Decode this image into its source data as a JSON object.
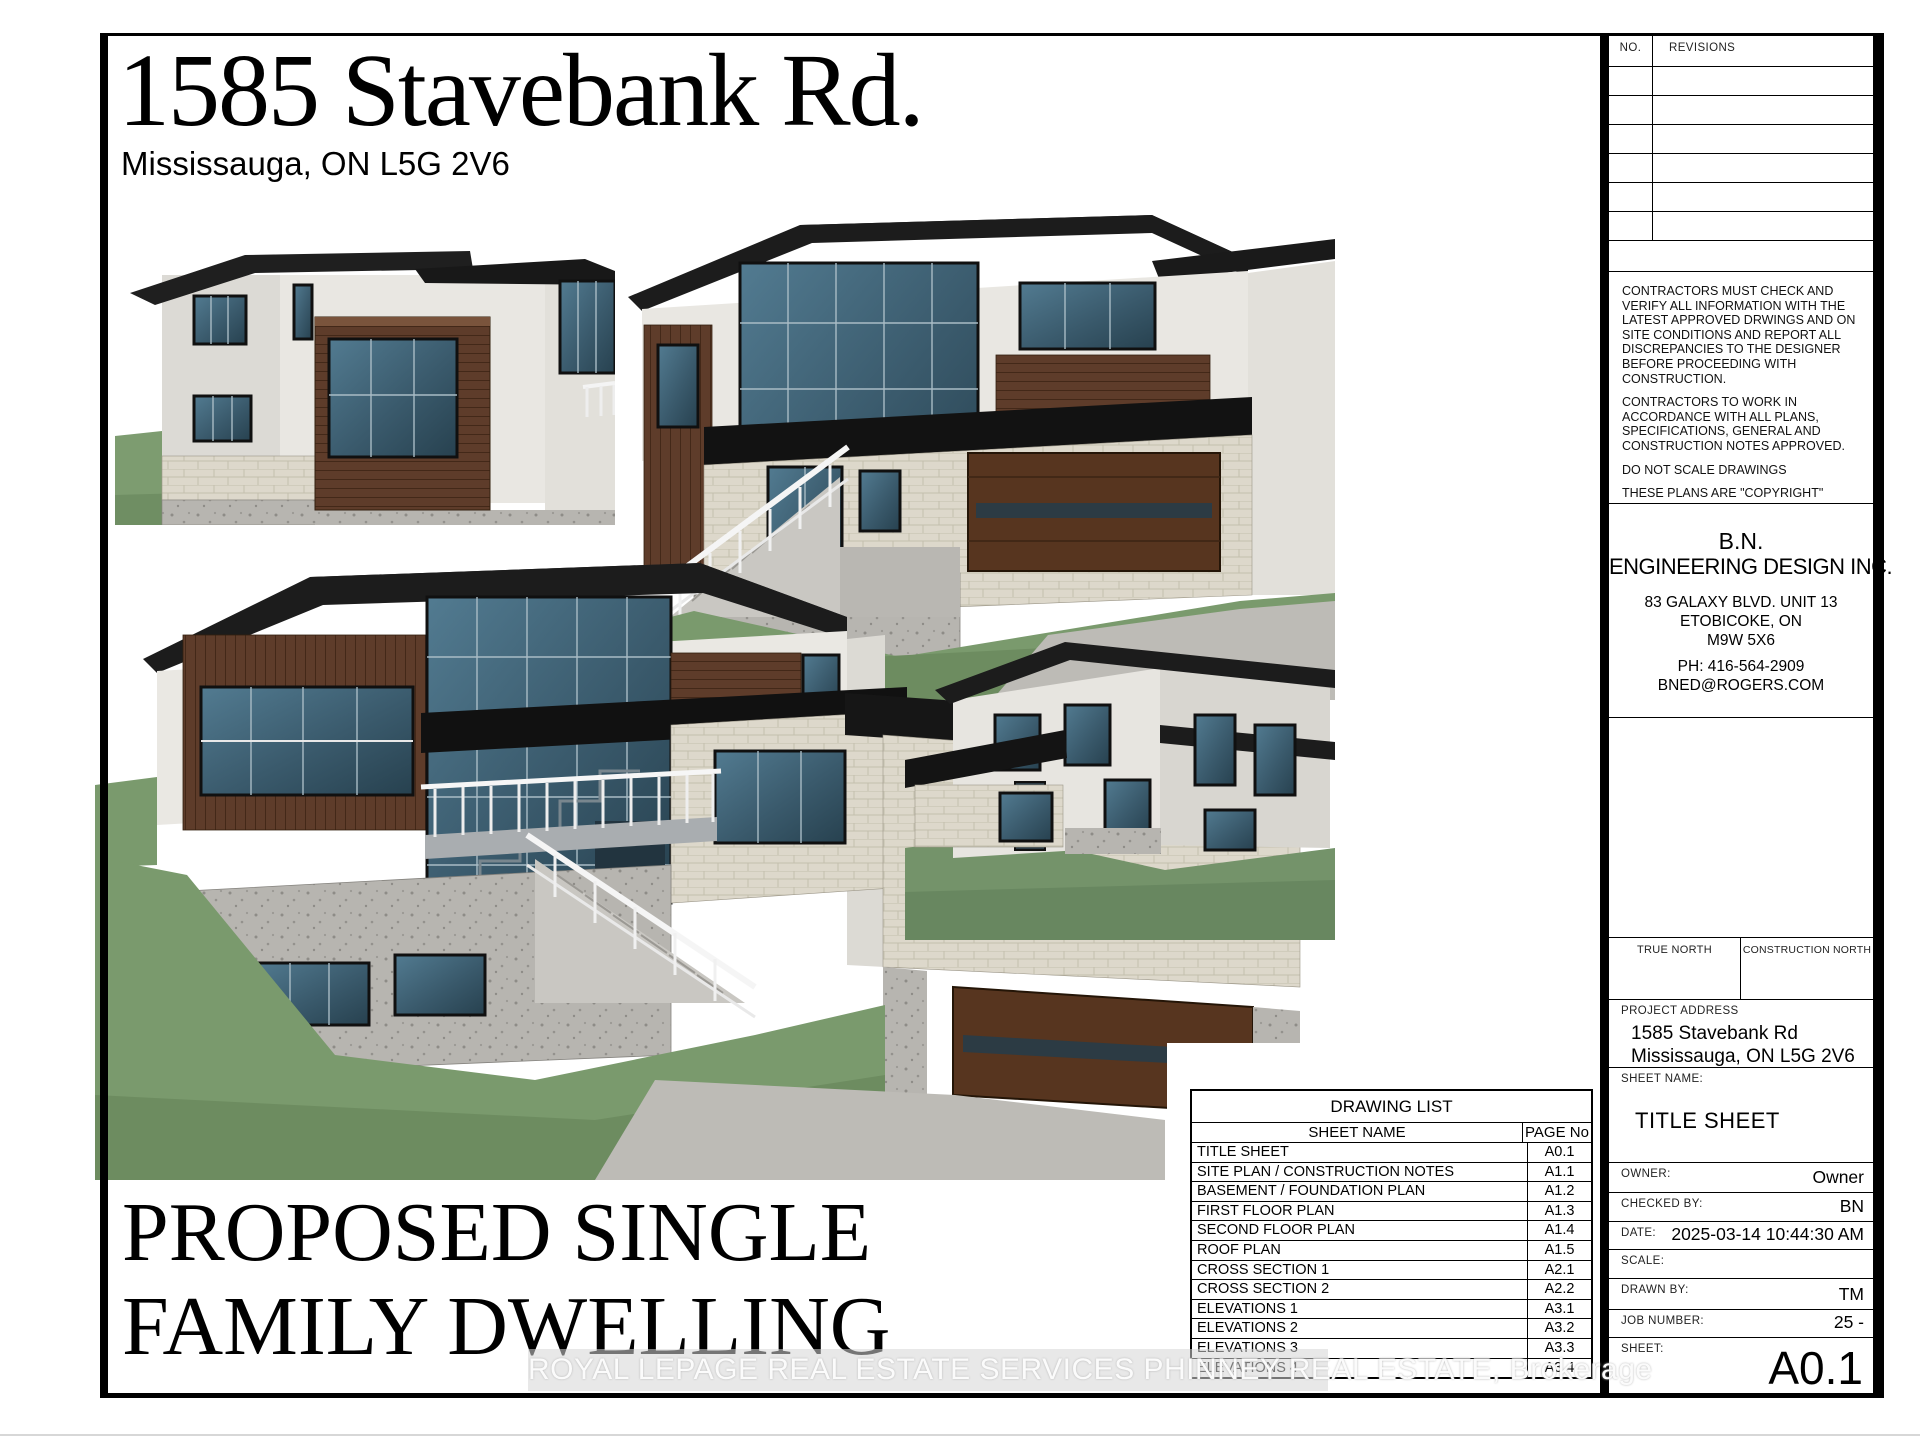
{
  "page": {
    "address_title": "1585 Stavebank Rd.",
    "address_subtitle": "Mississauga, ON L5G 2V6",
    "caption_line1": "PROPOSED SINGLE",
    "caption_line2": "FAMILY DWELLING",
    "watermark": "ROYAL LEPAGE REAL ESTATE SERVICES PHINNEY REAL ESTATE, Brokerage"
  },
  "revisions": {
    "no_label": "NO.",
    "revisions_label": "REVISIONS",
    "empty_rows": 6
  },
  "notes": {
    "paragraphs": [
      "CONTRACTORS MUST CHECK AND VERIFY ALL INFORMATION WITH THE LATEST APPROVED DRWINGS AND ON SITE CONDITIONS AND REPORT ALL DISCREPANCIES TO THE DESIGNER BEFORE PROCEEDING WITH CONSTRUCTION.",
      "CONTRACTORS TO WORK IN ACCORDANCE WITH ALL PLANS, SPECIFICATIONS, GENERAL AND CONSTRUCTION NOTES APPROVED.",
      "DO NOT SCALE DRAWINGS",
      "THESE PLANS ARE \"COPYRIGHT\" PROTECTED AND ARE THE PROPERTY OF THE DESIGNER. NO PLANS CAN BE USED WITH OUT WRITTEN CONSENT FROM THE DESIGNER AND STAMPED \"FINAL PLANS\""
    ]
  },
  "firm": {
    "name_line1": "B.N.",
    "name_line2": "ENGINEERING DESIGN INC.",
    "address_line1": "83 GALAXY BLVD. UNIT 13",
    "address_line2": "ETOBICOKE, ON",
    "address_line3": "M9W 5X6",
    "phone": "PH: 416-564-2909",
    "email": "BNED@ROGERS.COM"
  },
  "north": {
    "true_north_label": "TRUE NORTH",
    "construction_north_label": "CONSTRUCTION NORTH"
  },
  "title_block": {
    "project_address_label": "PROJECT ADDRESS",
    "project_address_line1": "1585 Stavebank Rd",
    "project_address_line2": "Mississauga, ON L5G 2V6",
    "sheet_name_label": "SHEET NAME:",
    "sheet_name": "TITLE SHEET",
    "owner_label": "OWNER:",
    "owner": "Owner",
    "checked_by_label": "CHECKED BY:",
    "checked_by": "BN",
    "date_label": "DATE:",
    "date": "2025-03-14 10:44:30 AM",
    "scale_label": "SCALE:",
    "scale": "",
    "drawn_by_label": "DRAWN BY:",
    "drawn_by": "TM",
    "job_number_label": "JOB NUMBER:",
    "job_number": "25 -",
    "sheet_label": "SHEET:",
    "sheet_number": "A0.1"
  },
  "drawing_list": {
    "title": "DRAWING LIST",
    "columns": [
      "SHEET NAME",
      "PAGE No"
    ],
    "rows": [
      [
        "TITLE SHEET",
        "A0.1"
      ],
      [
        "SITE PLAN / CONSTRUCTION NOTES",
        "A1.1"
      ],
      [
        "BASEMENT / FOUNDATION PLAN",
        "A1.2"
      ],
      [
        "FIRST FLOOR PLAN",
        "A1.3"
      ],
      [
        "SECOND FLOOR PLAN",
        "A1.4"
      ],
      [
        "ROOF PLAN",
        "A1.5"
      ],
      [
        "CROSS SECTION 1",
        "A2.1"
      ],
      [
        "CROSS SECTION 2",
        "A2.2"
      ],
      [
        "ELEVATIONS 1",
        "A3.1"
      ],
      [
        "ELEVATIONS 2",
        "A3.2"
      ],
      [
        "ELEVATIONS 3",
        "A3.3"
      ],
      [
        "ELEVATIONS 4",
        "A3.4"
      ]
    ]
  },
  "colors": {
    "roof": "#1c1c1c",
    "wall_white": "#e9e7e2",
    "wood_brown": "#5e3c2a",
    "window_glass": "#3d5f72",
    "grass": "#7a9a6d",
    "concrete": "#b7b5b0",
    "brick": "#ddd8cb",
    "line_black": "#000000"
  }
}
